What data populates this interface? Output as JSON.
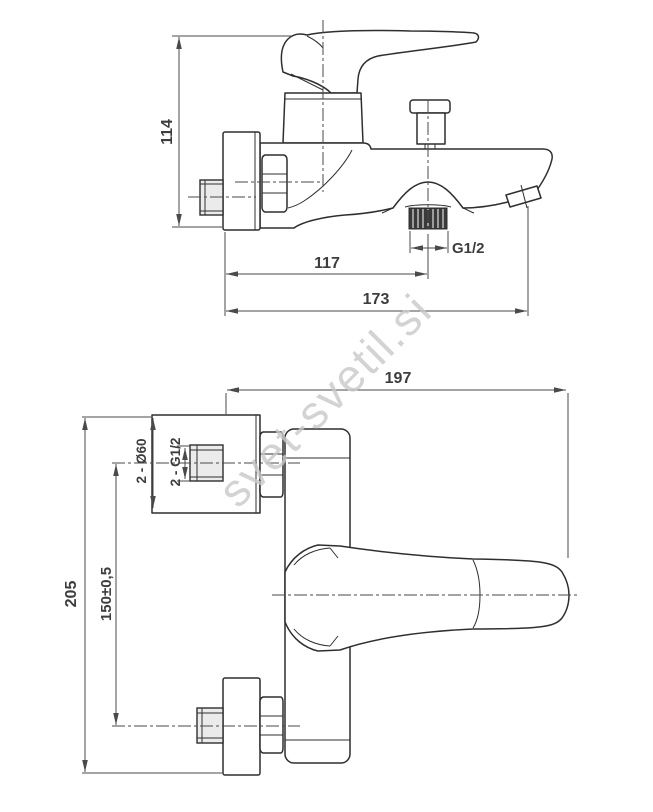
{
  "drawing": {
    "title": "wall-mounted bath mixer technical drawing, two orthographic views",
    "colors": {
      "background": "#ffffff",
      "line": "#2f2f2f",
      "dimension_text": "#3d3d3d",
      "thread_dark": "#3a3a3a",
      "pipe_shade": "#ebebeb",
      "watermark": "#c9c9c9"
    },
    "top_view": {
      "dim_height": "114",
      "dim_spout_projection": "117",
      "dim_total_projection": "173",
      "dim_shower_thread": "G1/2"
    },
    "bottom_view": {
      "dim_total_width": "197",
      "dim_total_height": "205",
      "dim_inlet_centers": "150±0,5",
      "dim_flange_diameter": "2 - Ø60",
      "dim_inlet_thread": "2 - G1/2"
    }
  },
  "watermark": {
    "text": "svet-svetil.si"
  }
}
